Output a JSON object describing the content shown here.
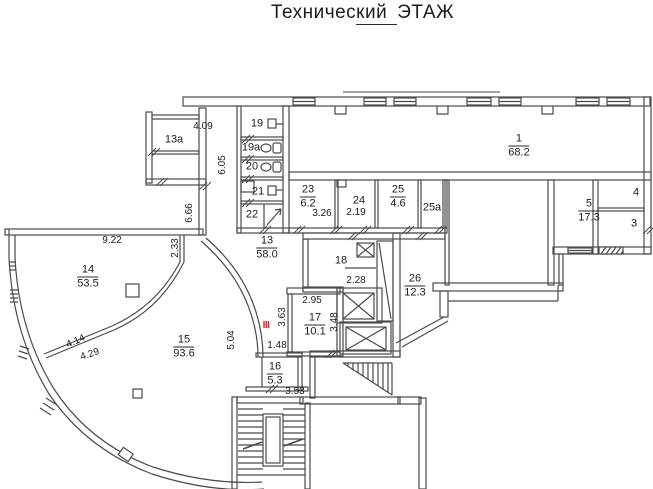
{
  "title": {
    "part1": "Техничес",
    "part2": "кий",
    "part3": "ЭТАЖ"
  },
  "rooms": [
    {
      "id": "1",
      "num": "1",
      "area": "68.2",
      "x": 519,
      "y": 146
    },
    {
      "id": "5",
      "num": "5",
      "area": "17.3",
      "x": 589,
      "y": 211
    },
    {
      "id": "4",
      "num": "4",
      "x": 636,
      "y": 193
    },
    {
      "id": "3",
      "num": "3",
      "x": 634,
      "y": 224
    },
    {
      "id": "13a",
      "num": "13а",
      "x": 174,
      "y": 140
    },
    {
      "id": "19",
      "num": "19",
      "x": 257,
      "y": 124
    },
    {
      "id": "19a",
      "num": "19а",
      "x": 251,
      "y": 148
    },
    {
      "id": "20",
      "num": "20",
      "x": 252,
      "y": 167
    },
    {
      "id": "21",
      "num": "21",
      "x": 258,
      "y": 192
    },
    {
      "id": "22",
      "num": "22",
      "x": 252,
      "y": 215
    },
    {
      "id": "23",
      "num": "23",
      "area": "6.2",
      "x": 308,
      "y": 197
    },
    {
      "id": "24",
      "num": "24",
      "x": 359,
      "y": 201
    },
    {
      "id": "25",
      "num": "25",
      "area": "4.6",
      "x": 398,
      "y": 197
    },
    {
      "id": "25a",
      "num": "25а",
      "x": 432,
      "y": 208
    },
    {
      "id": "13",
      "num": "13",
      "area": "58.0",
      "x": 267,
      "y": 248
    },
    {
      "id": "14",
      "num": "14",
      "area": "53.5",
      "x": 88,
      "y": 277
    },
    {
      "id": "15",
      "num": "15",
      "area": "93.6",
      "x": 184,
      "y": 347
    },
    {
      "id": "16",
      "num": "16",
      "area": "5.3",
      "x": 275,
      "y": 374
    },
    {
      "id": "17",
      "num": "17",
      "area": "10.1",
      "x": 315,
      "y": 325
    },
    {
      "id": "18",
      "num": "18",
      "x": 341,
      "y": 261
    },
    {
      "id": "26",
      "num": "26",
      "area": "12.3",
      "x": 415,
      "y": 286
    }
  ],
  "dimensions": [
    {
      "text": "4.09",
      "x": 203,
      "y": 127,
      "rot": 0
    },
    {
      "text": "6.05",
      "x": 223,
      "y": 165,
      "rot": -90
    },
    {
      "text": "6.66",
      "x": 190,
      "y": 213,
      "rot": -90
    },
    {
      "text": "9.22",
      "x": 112,
      "y": 241,
      "rot": 0
    },
    {
      "text": "2.33",
      "x": 176,
      "y": 248,
      "rot": -90
    },
    {
      "text": "4.14",
      "x": 76,
      "y": 342,
      "rot": -24
    },
    {
      "text": "4.29",
      "x": 90,
      "y": 355,
      "rot": -19
    },
    {
      "text": "5.04",
      "x": 232,
      "y": 340,
      "rot": -90
    },
    {
      "text": "1.48",
      "x": 277,
      "y": 346,
      "rot": 0
    },
    {
      "text": "3.26",
      "x": 322,
      "y": 214,
      "rot": 0
    },
    {
      "text": "2.19",
      "x": 356,
      "y": 213,
      "rot": 0
    },
    {
      "text": "2.95",
      "x": 312,
      "y": 301,
      "rot": 0
    },
    {
      "text": "3.63",
      "x": 283,
      "y": 317,
      "rot": -90
    },
    {
      "text": "3.48",
      "x": 335,
      "y": 322,
      "rot": -90
    },
    {
      "text": "2.28",
      "x": 356,
      "y": 281,
      "rot": 0
    },
    {
      "text": "3.53",
      "x": 295,
      "y": 392,
      "rot": 0
    }
  ],
  "marker": {
    "text": "III",
    "x": 266,
    "y": 326,
    "color": "#d3242b"
  }
}
